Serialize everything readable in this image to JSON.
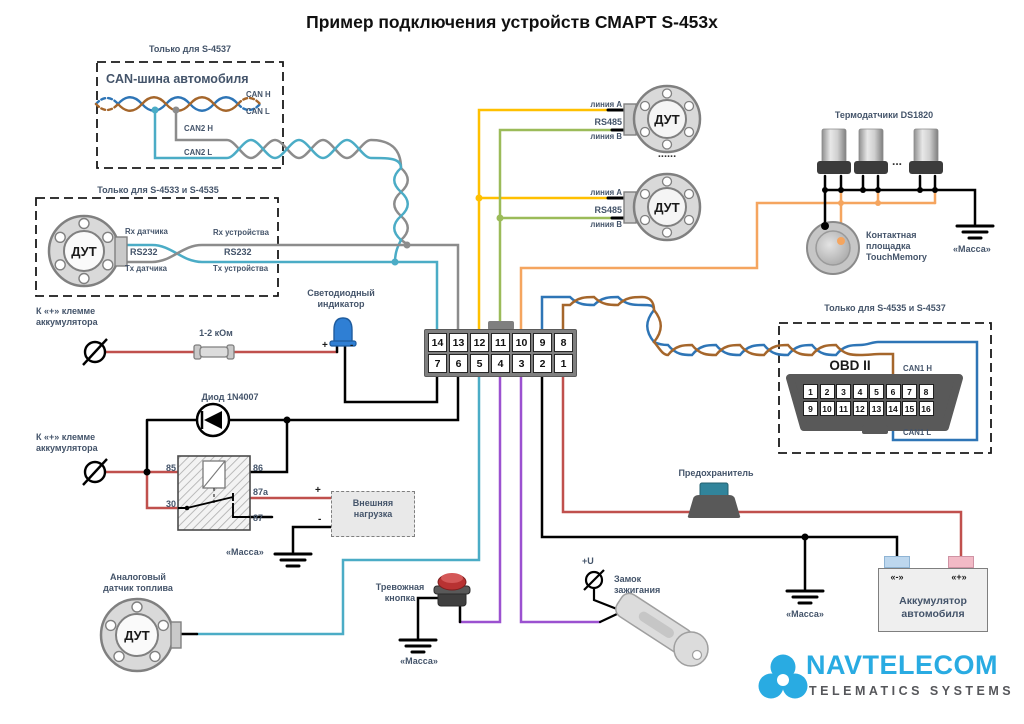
{
  "title": "Пример подключения устройств СМАРТ S-453x",
  "can_box": {
    "caption": "Только для S-4537",
    "heading": "CAN-шина автомобиля",
    "can_h": "CAN H",
    "can_l": "CAN L",
    "can2_h": "CAN2 H",
    "can2_l": "CAN2 L"
  },
  "rs232_box": {
    "caption": "Только для S-4533 и S-4535",
    "dut": "ДУТ",
    "rx_sensor": "Rx датчика",
    "tx_sensor": "Tx датчика",
    "rs232_sensor": "RS232",
    "rs232_device": "RS232",
    "rx_device": "Rx устройства",
    "tx_device": "Tx устройства"
  },
  "rs485_sensors": {
    "line_a_1": "линия А",
    "rs485_1": "RS485",
    "line_b_1": "линия B",
    "dut_1": "ДУТ",
    "dots": "......",
    "line_a_2": "линия А",
    "rs485_2": "RS485",
    "line_b_2": "линия B",
    "dut_2": "ДУТ"
  },
  "thermo": {
    "title": "Термодатчики DS1820",
    "ellipsis": "...",
    "touch_pad": "Контактная площадка TouchMemory",
    "ground": "«Масса»"
  },
  "obd_box": {
    "caption": "Только для S-4535 и S-4537",
    "title": "OBD II",
    "can1_h": "CAN1 H",
    "can1_l": "CAN1 L",
    "pins_top": [
      "1",
      "2",
      "3",
      "4",
      "5",
      "6",
      "7",
      "8"
    ],
    "pins_bottom": [
      "9",
      "10",
      "11",
      "12",
      "13",
      "14",
      "15",
      "16"
    ]
  },
  "device_connector": {
    "pins_top": [
      "14",
      "13",
      "12",
      "11",
      "10",
      "9",
      "8"
    ],
    "pins_bottom": [
      "7",
      "6",
      "5",
      "4",
      "3",
      "2",
      "1"
    ]
  },
  "led": {
    "label": "Светодиодный индикатор",
    "plus": "+",
    "minus": "-"
  },
  "resistor_label": "1-2 кОм",
  "battery_plus_label_1": "К «+» клемме аккумулятора",
  "battery_plus_label_2": "К «+» клемме аккумулятора",
  "diode_label": "Диод 1N4007",
  "relay": {
    "pin_85": "85",
    "pin_30": "30",
    "pin_86": "86",
    "pin_87a": "87a",
    "pin_87": "87"
  },
  "load": {
    "label": "Внешняя нагрузка",
    "plus": "+",
    "minus": "-",
    "ground": "«Масса»"
  },
  "fuel_sensor": {
    "label": "Аналоговый датчик топлива",
    "dut": "ДУТ"
  },
  "alarm_button": {
    "label": "Тревожная кнопка",
    "ground": "«Масса»"
  },
  "ignition": {
    "label": "Замок зажигания",
    "plus_u": "+U"
  },
  "fuse_label": "Предохранитель",
  "battery": {
    "label": "Аккумулятор автомобиля",
    "minus": "«-»",
    "plus": "«+»",
    "ground": "«Масса»"
  },
  "logo": {
    "brand": "NAVTELECOM",
    "tagline": "TELEMATICS SYSTEMS"
  }
}
